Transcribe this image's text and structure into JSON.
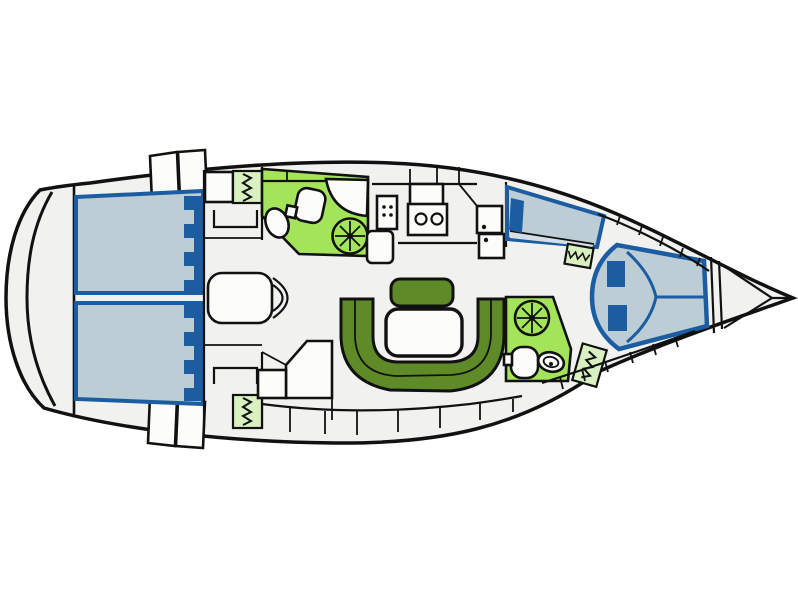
{
  "figure": {
    "kind": "sailing-yacht-interior-floor-plan",
    "orientation": "bow-right",
    "rooms": [
      "aft-cabin-port",
      "aft-cabin-starboard",
      "aft-head-with-shower",
      "galley",
      "salon-dinette",
      "forward-single-berth",
      "forward-cabin-double-berth",
      "forward-head-with-shower",
      "anchor-locker"
    ],
    "fixtures": {
      "double_berths_aft": 2,
      "forward_double_berth": 1,
      "single_berth": 1,
      "showers": 2,
      "toilets": 2,
      "sinks": 3,
      "galley_sink_bowls": 2,
      "stove_burners": 4,
      "hanging_lockers": 4,
      "salon_table": 1,
      "u_settee": 1,
      "bench_seat": 1,
      "nav_seat": 1
    }
  },
  "colors": {
    "background": "#ffffff",
    "outline": "#111111",
    "hull-fill": "#f1f1ef",
    "furniture": "#fcfcfa",
    "mattress": "#bccdd5",
    "mattress-border": "#1c5da2",
    "pillow": "#1c5da2",
    "settee": "#5e8b28",
    "head-green": "#a3e45a",
    "locker-green": "#d9f1c0",
    "shelf-strip": "#d3dfe4"
  }
}
